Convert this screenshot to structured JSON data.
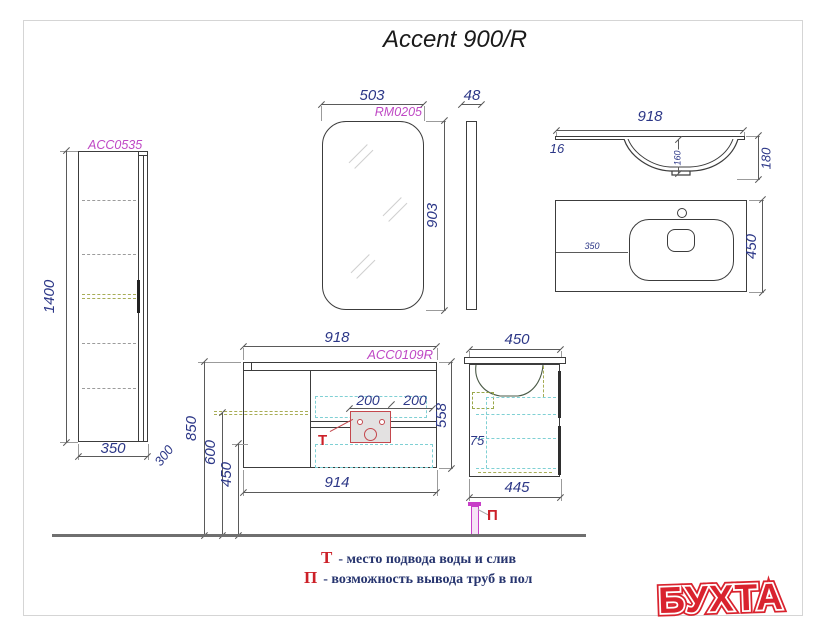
{
  "title": "Accent 900/R",
  "logo_text": "БУХТА",
  "legend": {
    "t_symbol": "Т",
    "t_text": "- место подвода воды и слив",
    "p_symbol": "П",
    "p_text": "- возможность вывода труб в пол"
  },
  "tall_cabinet": {
    "label": "ACC0535",
    "height": "1400",
    "width": "350",
    "depth": "300"
  },
  "mirror": {
    "label": "RM0205",
    "width": "503",
    "height": "903",
    "thickness": "48"
  },
  "washbasin_front": {
    "width": "918",
    "edge": "16",
    "bowl_depth": "160",
    "height": "180"
  },
  "washbasin_top": {
    "left_offset": "350",
    "depth": "450"
  },
  "vanity_front": {
    "label": "ACC0109R",
    "width": "918",
    "zone_left": "200",
    "zone_right": "200",
    "height": "558",
    "bottom_width": "914",
    "mount_height": "850",
    "drain_height": "600",
    "clearance": "450",
    "marker": "Т"
  },
  "vanity_side": {
    "depth": "450",
    "gap": "75",
    "bottom_depth": "445",
    "marker": "П"
  }
}
